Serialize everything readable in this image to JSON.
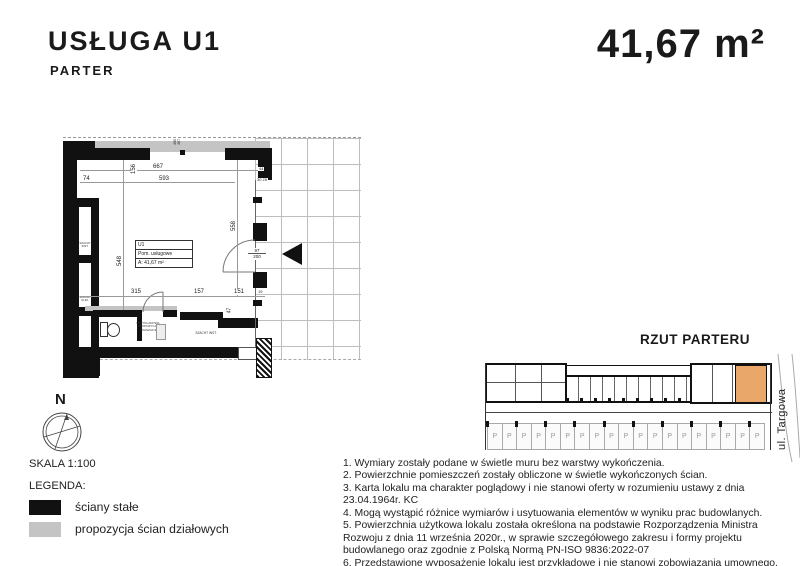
{
  "header": {
    "title": "USŁUGA U1",
    "subtitle": "PARTER",
    "area": "41,67 m²"
  },
  "plan": {
    "room_box": {
      "id": "U1",
      "usage": "Pom. usługowe",
      "area": "A: 41,67 m²"
    },
    "labels": {
      "arrangement_note": "PRZYKŁADOWA PROPOZYCJA ARANŻACJI",
      "shaft_room": "SZACHT INST.",
      "wall_niche_1": "SZACHT INST.",
      "wall_niche_2": "SZACHT KLIM."
    },
    "dimensions": {
      "top_total": "667",
      "top_inner": "593",
      "top_left": "74",
      "top_left_v": "156",
      "top_partition_a": "280",
      "top_partition_b": "287",
      "top_right_a": "44",
      "top_right_b": "30 25",
      "right_v": "558",
      "left_v": "548",
      "bottom_1": "315",
      "bottom_2": "157",
      "bottom_3": "151",
      "bottom_4": "19",
      "bottom_v": "47",
      "door_w": "97",
      "door_h": "200"
    }
  },
  "compass": {
    "north": "N"
  },
  "legend": {
    "scale": "SKALA 1:100",
    "title": "LEGENDA:",
    "items": [
      {
        "color": "#111111",
        "label": "ściany stałe"
      },
      {
        "color": "#c4c4c4",
        "label": "propozycja ścian działowych"
      }
    ]
  },
  "mini_plan": {
    "title": "RZUT PARTERU",
    "street": "ul. Targowa",
    "highlight_color": "#e9a86a",
    "parking": {
      "stall_label": "P",
      "stall_count": 19
    }
  },
  "notes": [
    "1. Wymiary zostały podane w świetle muru bez warstwy wykończenia.",
    "2. Powierzchnie pomieszczeń zostały obliczone w świetle wykończonych ścian.",
    "3. Karta lokalu ma charakter poglądowy i nie stanowi oferty w rozumieniu ustawy z dnia 23.04.1964r. KC",
    "4. Mogą wystąpić różnice wymiarów i usytuowania elementów w wyniku prac budowlanych.",
    "5. Powierzchnia użytkowa lokalu została określona na podstawie Rozporządzenia Ministra Rozwoju z dnia 11 września 2020r., w sprawie szczegółowego zakresu i formy projektu budowlanego oraz zgodnie z Polską Normą PN-ISO 9836:2022-07",
    "6. Przedstawione wyposażenie lokalu jest przykładowe i nie stanowi zobowiązania umownego."
  ]
}
